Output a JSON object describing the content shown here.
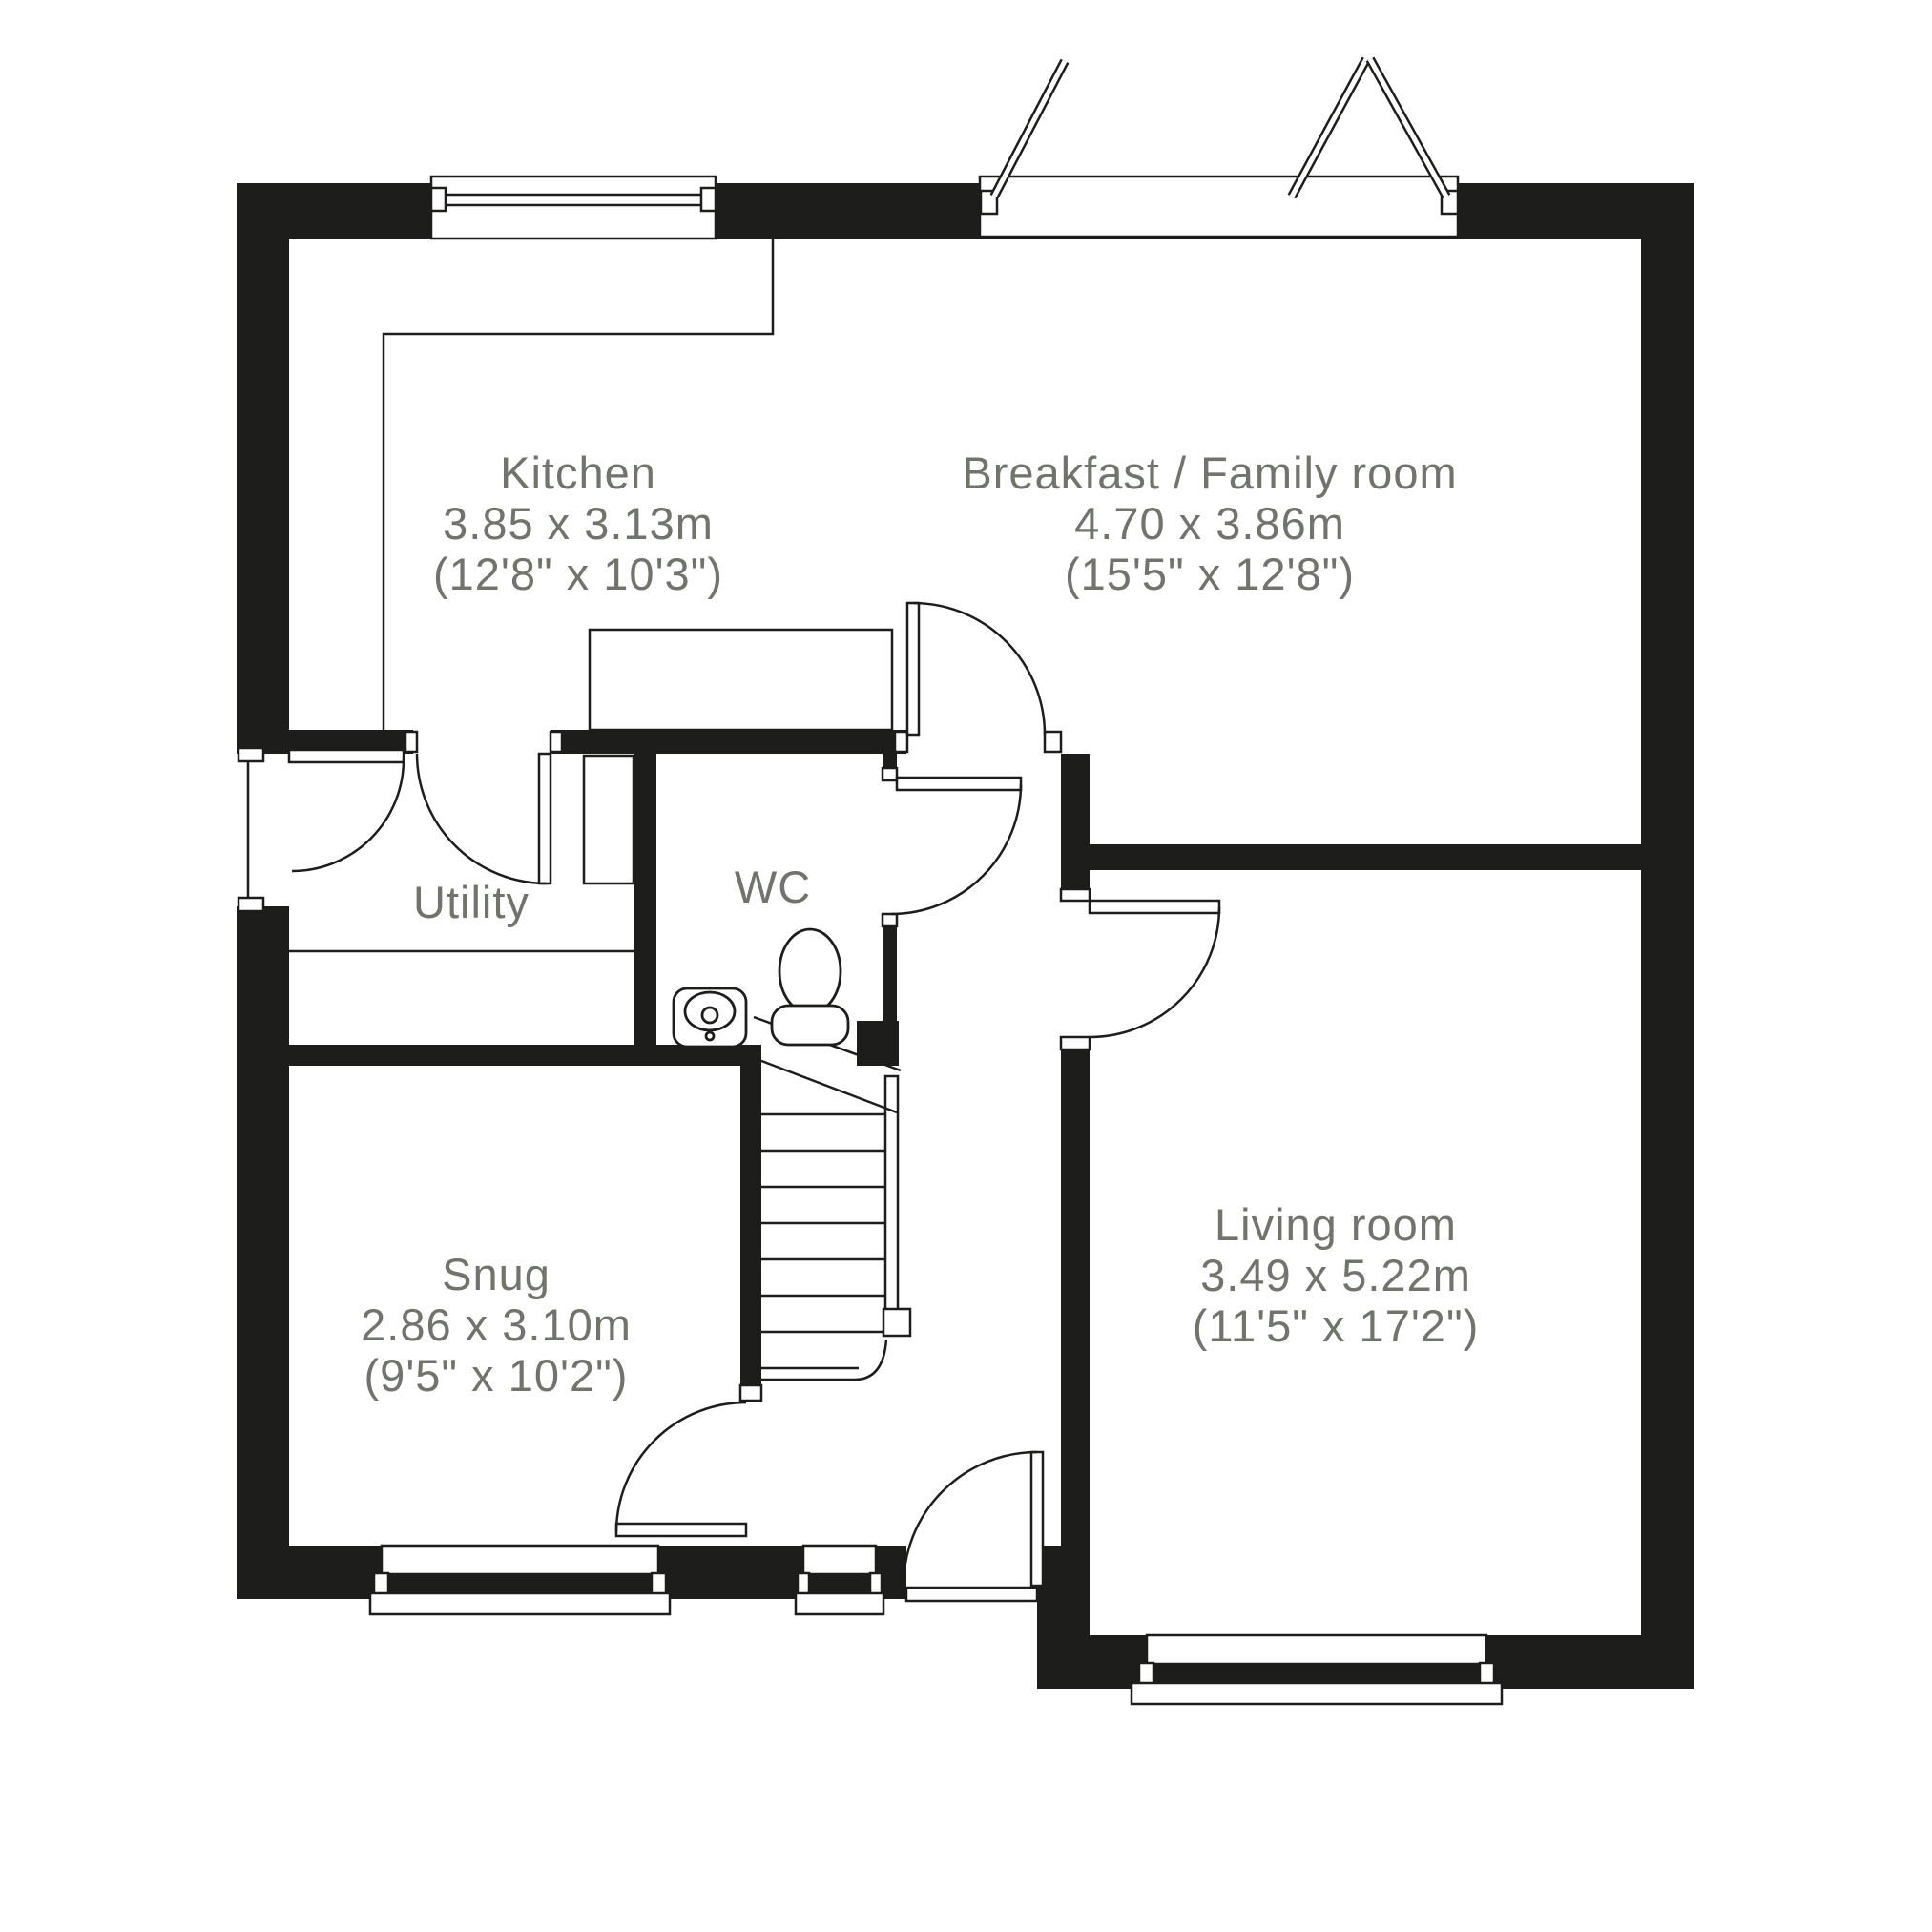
{
  "plan": {
    "background": "#ffffff",
    "wall_color": "#1d1d1b",
    "line_color": "#1d1d1b",
    "label_color": "#70746a"
  },
  "rooms": [
    {
      "id": "kitchen",
      "name": "Kitchen",
      "dimensions_m": "3.85 x 3.13m",
      "dimensions_ft": "(12'8\" x 10'3\")"
    },
    {
      "id": "breakfast",
      "name": "Breakfast / Family room",
      "dimensions_m": "4.70 x 3.86m",
      "dimensions_ft": "(15'5\" x 12'8\")"
    },
    {
      "id": "utility",
      "name": "Utility"
    },
    {
      "id": "wc",
      "name": "WC"
    },
    {
      "id": "snug",
      "name": "Snug",
      "dimensions_m": "2.86 x 3.10m",
      "dimensions_ft": "(9'5\" x 10'2\")"
    },
    {
      "id": "living",
      "name": "Living room",
      "dimensions_m": "3.49 x 5.22m",
      "dimensions_ft": "(11'5\" x 17'2\")"
    }
  ]
}
